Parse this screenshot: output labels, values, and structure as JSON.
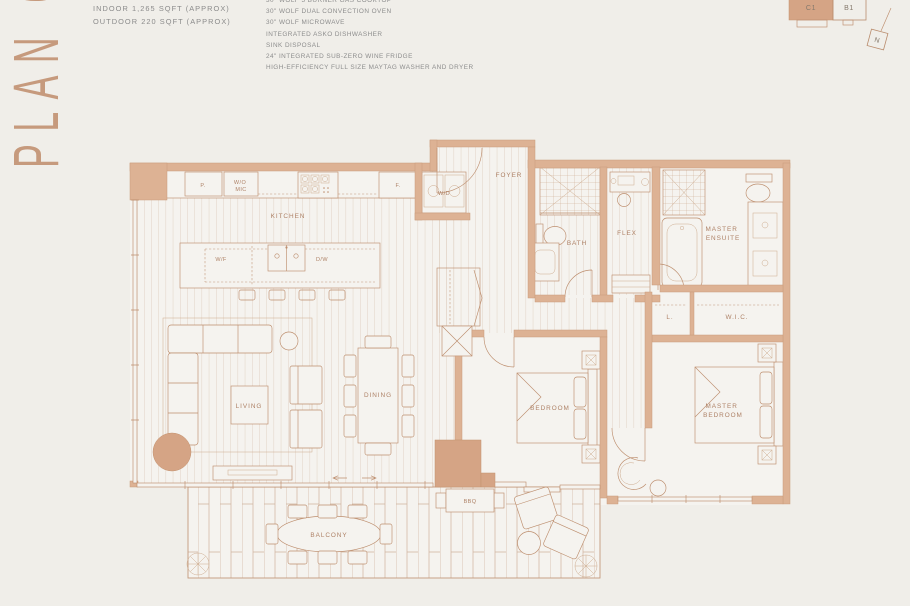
{
  "header": {
    "plan_title": "PLAN C1",
    "indoor_area": "INDOOR 1,265 SQFT (APPROX)",
    "outdoor_area": "OUTDOOR 220 SQFT (APPROX)",
    "features": [
      "30\" WOLF 5 BURNER GAS COOKTOP",
      "30\" WOLF DUAL CONVECTION OVEN",
      "30\" WOLF MICROWAVE",
      "INTEGRATED ASKO DISHWASHER",
      "SINK DISPOSAL",
      "24\" INTEGRATED SUB-ZERO WINE FRIDGE",
      "HIGH-EFFICIENCY FULL SIZE MAYTAG WASHER AND DRYER"
    ]
  },
  "keyplan": {
    "highlighted_unit": "C1",
    "adjacent_unit": "B1",
    "north_label": "N"
  },
  "rooms": {
    "kitchen": "KITCHEN",
    "foyer": "FOYER",
    "bath": "BATH",
    "flex": "FLEX",
    "master_ensuite_l1": "MASTER",
    "master_ensuite_l2": "ENSUITE",
    "linen": "L.",
    "wic": "W.I.C.",
    "bedroom": "BEDROOM",
    "master_bedroom_l1": "MASTER",
    "master_bedroom_l2": "BEDROOM",
    "living": "LIVING",
    "dining": "DINING",
    "balcony": "BALCONY",
    "bbq": "BBQ"
  },
  "fixtures": {
    "pantry": "P.",
    "wall_oven": "W/O",
    "microwave": "MIC",
    "fridge": "F.",
    "wine_fridge": "W/F",
    "dishwasher": "D/W",
    "washer_dryer": "W/D"
  },
  "colors": {
    "wall": "#ddb294",
    "accent": "#d5a485",
    "line": "#bd8e6e",
    "label": "#ae8267",
    "text_gray": "#8d8d8d",
    "background": "#f0eee9"
  }
}
